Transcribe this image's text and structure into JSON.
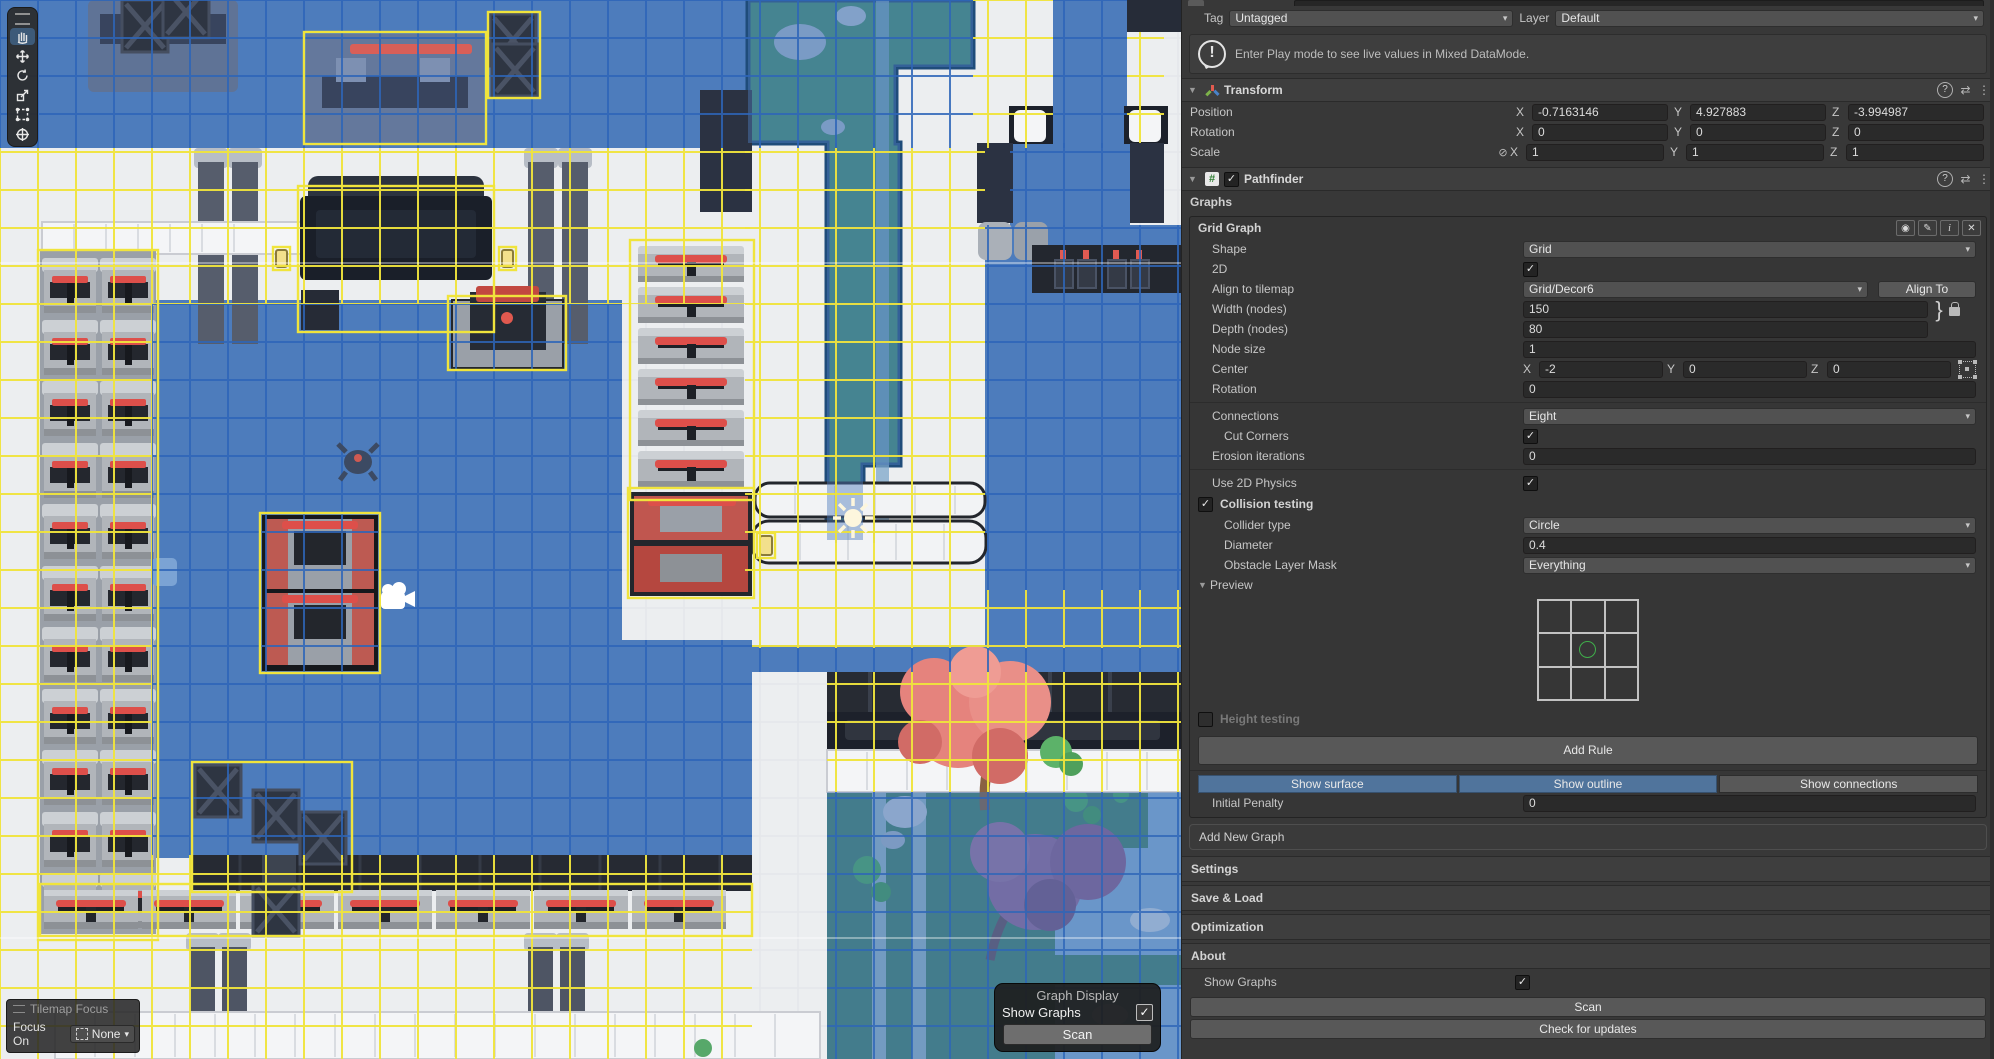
{
  "colors": {
    "graph_surface_blue": "#4d7cbc",
    "graph_grid_blue": "#2d65b8",
    "graph_outline_yellow": "#f0e43c",
    "segment_active_blue": "#50749c",
    "preview_node_green": "#3fae4a"
  },
  "scene": {
    "toolbar": {
      "tools": [
        {
          "name": "hand-tool",
          "selected": true
        },
        {
          "name": "move-tool",
          "selected": false
        },
        {
          "name": "rotate-tool",
          "selected": false
        },
        {
          "name": "scale-tool",
          "selected": false
        },
        {
          "name": "rect-tool",
          "selected": false
        },
        {
          "name": "transform-tool",
          "selected": false
        }
      ]
    },
    "tilemap_focus": {
      "title": "Tilemap Focus",
      "focus_on_label": "Focus On",
      "value": "None"
    },
    "graph_display": {
      "title": "Graph Display",
      "show_graphs_label": "Show Graphs",
      "show_graphs_checked": true,
      "scan_label": "Scan",
      "check_glyph": "✓"
    }
  },
  "inspector": {
    "tag_row": {
      "tag_label": "Tag",
      "tag_value": "Untagged",
      "layer_label": "Layer",
      "layer_value": "Default"
    },
    "help_box": {
      "text": "Enter Play mode to see live values in Mixed DataMode."
    },
    "transform": {
      "title": "Transform",
      "axis": {
        "x": "X",
        "y": "Y",
        "z": "Z"
      },
      "rows": [
        {
          "label": "Position",
          "x": "-0.7163146",
          "y": "4.927883",
          "z": "-3.994987"
        },
        {
          "label": "Rotation",
          "x": "0",
          "y": "0",
          "z": "0"
        },
        {
          "label": "Scale",
          "x": "1",
          "y": "1",
          "z": "1"
        }
      ]
    },
    "pathfinder": {
      "title": "Pathfinder",
      "checked": true,
      "script_glyph": "#",
      "graphs_label": "Graphs"
    },
    "grid_graph": {
      "title": "Grid Graph",
      "shape": {
        "label": "Shape",
        "value": "Grid"
      },
      "two_d": {
        "label": "2D",
        "checked": true
      },
      "align": {
        "label": "Align to tilemap",
        "value": "Grid/Decor6",
        "button": "Align To"
      },
      "width": {
        "label": "Width (nodes)",
        "value": "150"
      },
      "depth": {
        "label": "Depth (nodes)",
        "value": "80"
      },
      "node_size": {
        "label": "Node size",
        "value": "1"
      },
      "center": {
        "label": "Center",
        "x": "-2",
        "y": "0",
        "z": "0"
      },
      "rotation": {
        "label": "Rotation",
        "value": "0"
      },
      "connections": {
        "label": "Connections",
        "value": "Eight"
      },
      "cut_corners": {
        "label": "Cut Corners",
        "checked": true
      },
      "erosion": {
        "label": "Erosion iterations",
        "value": "0"
      },
      "use_2d_physics": {
        "label": "Use 2D Physics",
        "checked": true
      },
      "collision_testing": {
        "label": "Collision testing",
        "checked": true
      },
      "collider_type": {
        "label": "Collider type",
        "value": "Circle"
      },
      "diameter": {
        "label": "Diameter",
        "value": "0.4"
      },
      "obstacle_mask": {
        "label": "Obstacle Layer Mask",
        "value": "Everything"
      },
      "preview_label": "Preview",
      "height_testing": {
        "label": "Height testing",
        "checked": false
      },
      "add_rule_label": "Add Rule",
      "display_buttons": [
        {
          "label": "Show surface",
          "active": true
        },
        {
          "label": "Show outline",
          "active": true
        },
        {
          "label": "Show connections",
          "active": false
        }
      ],
      "initial_penalty": {
        "label": "Initial Penalty",
        "value": "0"
      }
    },
    "add_new_graph_label": "Add New Graph",
    "sections": [
      "Settings",
      "Save & Load",
      "Optimization",
      "About"
    ],
    "show_graphs": {
      "label": "Show Graphs",
      "checked": true
    },
    "scan_label": "Scan",
    "check_updates_label": "Check for updates",
    "glyphs": {
      "check": "✓",
      "fold_open": "▼",
      "dropdown": "▾",
      "kebab": "⋮",
      "help": "?",
      "presets": "⇄",
      "info": "i",
      "close": "✕",
      "eye": "◉",
      "pencil": "✎",
      "brace": "}",
      "link_slash": "⊘",
      "bang": "!"
    }
  }
}
